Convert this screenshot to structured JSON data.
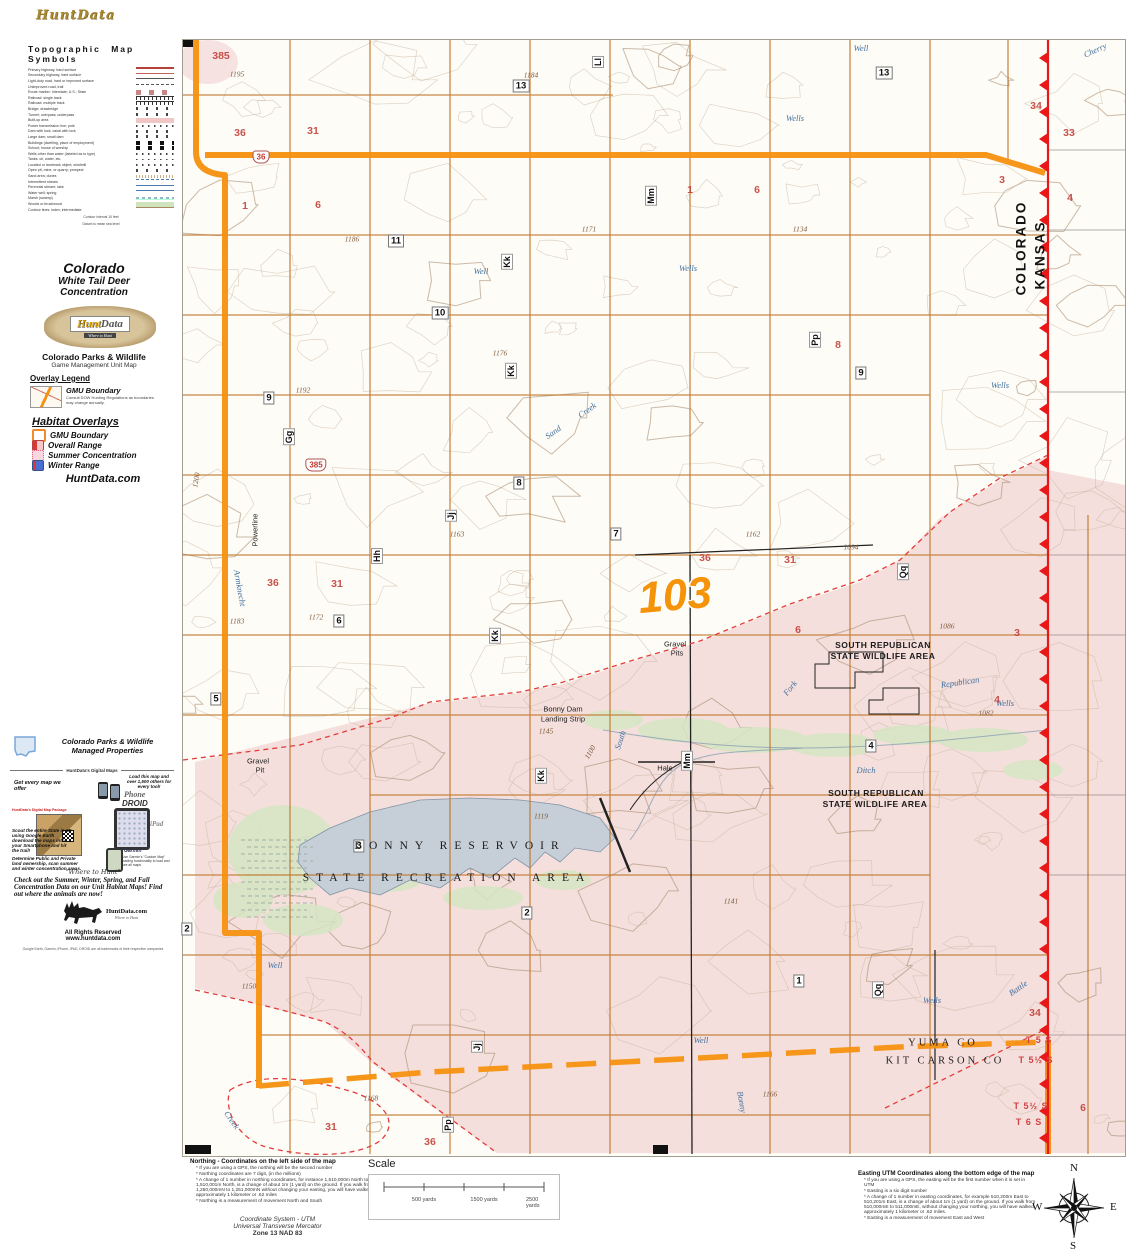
{
  "brand": {
    "script_logo": "HuntData",
    "name_hunt": "Hunt",
    "name_data": "Data",
    "tagline": "Where to Hunt",
    "site": "HuntData.com"
  },
  "sidebar": {
    "topo_legend": {
      "title": "Topographic  Map  Symbols",
      "items": [
        {
          "label": "Primary highway, hard surface",
          "sym": "red"
        },
        {
          "label": "Secondary highway, hard surface",
          "sym": "red2"
        },
        {
          "label": "Light-duty road, hard or improved surface",
          "sym": "thin"
        },
        {
          "label": "Unimproved road, trail",
          "sym": "dash"
        },
        {
          "label": "Route marker: Interstate; U.S.; State",
          "sym": "shield"
        },
        {
          "label": "Railroad: single track",
          "sym": "rr"
        },
        {
          "label": "Railroad: multiple track",
          "sym": "rr"
        },
        {
          "label": "Bridge; drawbridge",
          "sym": "tick"
        },
        {
          "label": "Tunnel; overpass; underpass",
          "sym": "tick"
        },
        {
          "label": "Built-up area",
          "sym": "pink"
        },
        {
          "label": "Power transmission line; pole",
          "sym": "dots"
        },
        {
          "label": "Dam with lock; canal with lock",
          "sym": "tick"
        },
        {
          "label": "Large dam; small dam",
          "sym": "tick"
        },
        {
          "label": "Buildings (dwelling, place of employment)",
          "sym": "blk"
        },
        {
          "label": "School; house of worship",
          "sym": "blk"
        },
        {
          "label": "Wells other than water (labeled as to type)",
          "sym": "dots"
        },
        {
          "label": "Tanks: oil, water, etc.",
          "sym": "dots"
        },
        {
          "label": "Located or landmark object; windmill",
          "sym": "dots"
        },
        {
          "label": "Open pit, mine, or quarry; prospect",
          "sym": "tick"
        },
        {
          "label": "Sand area; dunes",
          "sym": "stip"
        },
        {
          "label": "Intermittent stream",
          "sym": "bdash"
        },
        {
          "label": "Perennial stream; lake",
          "sym": "blue"
        },
        {
          "label": "Water well; spring",
          "sym": "blue"
        },
        {
          "label": "Marsh (swamp)",
          "sym": "marsh"
        },
        {
          "label": "Woods or brushwood",
          "sym": "green"
        },
        {
          "label": "Contour lines: index; intermediate",
          "sym": "cont"
        }
      ],
      "footnote1": "Contour interval 10 feet",
      "footnote2": "Datum is mean sea level"
    },
    "title_block": {
      "line1": "Colorado",
      "line2": "White Tail Deer",
      "line3": "Concentration"
    },
    "agency": {
      "line1": "Colorado Parks & Wildlife",
      "line2": "Game Management Unit Map"
    },
    "overlay_legend": {
      "title": "Overlay Legend",
      "item": "GMU Boundary",
      "note1": "Consult DOW Hunting Regulations as",
      "note2": "boundaries may change annually."
    },
    "habitat": {
      "title": "Habitat Overlays",
      "items": [
        {
          "label": "GMU Boundary",
          "style": "gmu",
          "color": "#f28c28"
        },
        {
          "label": "Overall Range",
          "style": "overall",
          "color": "#d43a3a"
        },
        {
          "label": "Summer Concentration",
          "style": "summer",
          "color": "#f2a0b4"
        },
        {
          "label": "Winter Range",
          "style": "winter",
          "color": "#4a6fd0"
        }
      ],
      "footer": "HuntData.com"
    },
    "managed": {
      "line1": "Colorado Parks & Wildlife",
      "line2": "Managed Properties"
    },
    "digital": {
      "header": "HuntData's Digital Maps",
      "left_pitch": "Get every map we offer",
      "right_pitch": "Load this map and over 1,500 others for every tool!",
      "phone": "Phone",
      "droid": "DROID",
      "ipad": "iPad",
      "garmin": "Garmin",
      "package": "HuntData's Digital Map Package",
      "scout": "Scout the entire State in 3D using Google Earth download the maps into your Smartphone and hit the trail!",
      "garmin_note": "Use Garmin's \"Custom Map\" loading functionality to load and see all maps",
      "determine": "Determine Public and Private land ownership, scan summer and winter concentration areas."
    },
    "where_script": "\"Where to Hunt\"",
    "promo": "Check out the Summer, Winter, Spring, and Fall Concentration Data on our Unit Habitat Maps!  Find out where the animals are now!",
    "rights": {
      "line1": "All Rights Reserved",
      "line2": "www.huntdata.com",
      "trademark": "Google Earth, Garmin, iPhone, iPAD, DROID are all trademarks of their respective companies"
    }
  },
  "map": {
    "unit": "103",
    "colors": {
      "gmu_boundary": "#f5930a",
      "state_line": "#e81818",
      "overall_range_fill": "#f3d7d6",
      "lake": "#c6cfd8",
      "section_number": "#c23b35"
    },
    "labels": [
      {
        "c": "mm",
        "t": "13",
        "x": 338,
        "y": 46
      },
      {
        "c": "mm",
        "t": "13",
        "x": 701,
        "y": 33
      },
      {
        "c": "mm",
        "t": "11",
        "x": 213,
        "y": 201
      },
      {
        "c": "mm",
        "t": "10",
        "x": 257,
        "y": 273
      },
      {
        "c": "mm",
        "t": "9",
        "x": 86,
        "y": 358
      },
      {
        "c": "mm",
        "t": "9",
        "x": 678,
        "y": 333
      },
      {
        "c": "mm",
        "t": "8",
        "x": 336,
        "y": 443
      },
      {
        "c": "mm",
        "t": "7",
        "x": 433,
        "y": 494
      },
      {
        "c": "mm",
        "t": "6",
        "x": 156,
        "y": 581
      },
      {
        "c": "mm",
        "t": "5",
        "x": 33,
        "y": 659
      },
      {
        "c": "mm",
        "t": "4",
        "x": 688,
        "y": 706
      },
      {
        "c": "mm",
        "t": "3",
        "x": 176,
        "y": 806
      },
      {
        "c": "mm",
        "t": "2",
        "x": 344,
        "y": 873
      },
      {
        "c": "mm",
        "t": "2",
        "x": 4,
        "y": 889
      },
      {
        "c": "mm",
        "t": "1",
        "x": 616,
        "y": 941
      },
      {
        "c": "sec",
        "t": "385",
        "x": 38,
        "y": 16
      },
      {
        "c": "sec",
        "t": "36",
        "x": 57,
        "y": 93
      },
      {
        "c": "sec",
        "t": "31",
        "x": 130,
        "y": 91
      },
      {
        "c": "sec",
        "t": "1",
        "x": 62,
        "y": 166
      },
      {
        "c": "sec",
        "t": "6",
        "x": 135,
        "y": 165
      },
      {
        "c": "sec",
        "t": "1",
        "x": 507,
        "y": 150
      },
      {
        "c": "sec",
        "t": "6",
        "x": 574,
        "y": 150
      },
      {
        "c": "sec",
        "t": "34",
        "x": 853,
        "y": 66
      },
      {
        "c": "sec",
        "t": "33",
        "x": 886,
        "y": 93
      },
      {
        "c": "sec",
        "t": "3",
        "x": 819,
        "y": 140
      },
      {
        "c": "sec",
        "t": "4",
        "x": 887,
        "y": 158
      },
      {
        "c": "sec",
        "t": "8",
        "x": 655,
        "y": 305
      },
      {
        "c": "sec",
        "t": "36",
        "x": 90,
        "y": 543
      },
      {
        "c": "sec",
        "t": "31",
        "x": 154,
        "y": 544
      },
      {
        "c": "sec",
        "t": "36",
        "x": 522,
        "y": 518
      },
      {
        "c": "sec",
        "t": "31",
        "x": 607,
        "y": 520
      },
      {
        "c": "sec",
        "t": "6",
        "x": 615,
        "y": 590
      },
      {
        "c": "sec",
        "t": "3",
        "x": 834,
        "y": 593
      },
      {
        "c": "sec",
        "t": "4",
        "x": 814,
        "y": 660
      },
      {
        "c": "sec",
        "t": "34",
        "x": 852,
        "y": 973
      },
      {
        "c": "sec",
        "t": "6",
        "x": 900,
        "y": 1068
      },
      {
        "c": "sec",
        "t": "31",
        "x": 148,
        "y": 1087
      },
      {
        "c": "sec",
        "t": "36",
        "x": 247,
        "y": 1102
      },
      {
        "c": "sh",
        "t": "36",
        "x": 78,
        "y": 117
      },
      {
        "c": "sh",
        "t": "385",
        "x": 133,
        "y": 425
      },
      {
        "c": "rd",
        "t": "Ll",
        "x": 415,
        "y": 22,
        "r": -90
      },
      {
        "c": "rd",
        "t": "Mm",
        "x": 468,
        "y": 156,
        "r": -90
      },
      {
        "c": "rd",
        "t": "Kk",
        "x": 324,
        "y": 222,
        "r": -90
      },
      {
        "c": "rd",
        "t": "Kk",
        "x": 328,
        "y": 331,
        "r": -90
      },
      {
        "c": "rd",
        "t": "Gg",
        "x": 106,
        "y": 397,
        "r": -90
      },
      {
        "c": "rd",
        "t": "Hh",
        "x": 194,
        "y": 516,
        "r": -90
      },
      {
        "c": "rd",
        "t": "Jj",
        "x": 268,
        "y": 476,
        "r": -90
      },
      {
        "c": "rd",
        "t": "Kk",
        "x": 312,
        "y": 596,
        "r": -90
      },
      {
        "c": "rd",
        "t": "Kk",
        "x": 358,
        "y": 736,
        "r": -90
      },
      {
        "c": "rd",
        "t": "Mm",
        "x": 504,
        "y": 721,
        "r": -90
      },
      {
        "c": "rd",
        "t": "Pp",
        "x": 632,
        "y": 300,
        "r": -90
      },
      {
        "c": "rd",
        "t": "Qq",
        "x": 720,
        "y": 532,
        "r": -90
      },
      {
        "c": "rd",
        "t": "Jj",
        "x": 294,
        "y": 1007,
        "r": -90
      },
      {
        "c": "rd",
        "t": "Pp",
        "x": 265,
        "y": 1085,
        "r": -90
      },
      {
        "c": "rd",
        "t": "Qq",
        "x": 695,
        "y": 950,
        "r": -90
      },
      {
        "c": "el",
        "t": "1195",
        "x": 54,
        "y": 34
      },
      {
        "c": "el",
        "t": "1184",
        "x": 348,
        "y": 35
      },
      {
        "c": "el",
        "t": "1186",
        "x": 169,
        "y": 199
      },
      {
        "c": "el",
        "t": "1171",
        "x": 406,
        "y": 189
      },
      {
        "c": "el",
        "t": "1134",
        "x": 617,
        "y": 189
      },
      {
        "c": "el",
        "t": "1176",
        "x": 317,
        "y": 313
      },
      {
        "c": "el",
        "t": "1192",
        "x": 120,
        "y": 350
      },
      {
        "c": "el",
        "t": "1163",
        "x": 274,
        "y": 494
      },
      {
        "c": "el",
        "t": "1162",
        "x": 570,
        "y": 494
      },
      {
        "c": "el",
        "t": "1094",
        "x": 668,
        "y": 507
      },
      {
        "c": "el",
        "t": "1172",
        "x": 133,
        "y": 577
      },
      {
        "c": "el",
        "t": "1183",
        "x": 54,
        "y": 581
      },
      {
        "c": "el",
        "t": "1086",
        "x": 764,
        "y": 586
      },
      {
        "c": "el",
        "t": "1082",
        "x": 803,
        "y": 673
      },
      {
        "c": "el",
        "t": "1145",
        "x": 363,
        "y": 691
      },
      {
        "c": "el",
        "t": "1100",
        "x": 407,
        "y": 712,
        "r": -60
      },
      {
        "c": "el",
        "t": "1119",
        "x": 358,
        "y": 776
      },
      {
        "c": "el",
        "t": "1141",
        "x": 548,
        "y": 861
      },
      {
        "c": "el",
        "t": "1150",
        "x": 66,
        "y": 946
      },
      {
        "c": "el",
        "t": "1168",
        "x": 188,
        "y": 1058
      },
      {
        "c": "el",
        "t": "1166",
        "x": 587,
        "y": 1054
      },
      {
        "c": "el",
        "t": "1200",
        "x": 13,
        "y": 440,
        "r": -80
      },
      {
        "c": "wa",
        "t": "Well",
        "x": 298,
        "y": 231
      },
      {
        "c": "wa",
        "t": "Wells",
        "x": 505,
        "y": 228
      },
      {
        "c": "wa",
        "t": "Wells",
        "x": 612,
        "y": 78
      },
      {
        "c": "wa",
        "t": "Well",
        "x": 678,
        "y": 8
      },
      {
        "c": "wa",
        "t": "Wells",
        "x": 817,
        "y": 345
      },
      {
        "c": "wa",
        "t": "Wells",
        "x": 822,
        "y": 663
      },
      {
        "c": "wa",
        "t": "Wells",
        "x": 749,
        "y": 960
      },
      {
        "c": "wa",
        "t": "Well",
        "x": 92,
        "y": 925
      },
      {
        "c": "wa",
        "t": "Well",
        "x": 518,
        "y": 1000
      },
      {
        "c": "wa",
        "t": "Sand",
        "x": 370,
        "y": 392,
        "r": -35
      },
      {
        "c": "wa",
        "t": "Creek",
        "x": 404,
        "y": 370,
        "r": -35
      },
      {
        "c": "wa",
        "t": "Republican",
        "x": 777,
        "y": 642,
        "r": -8
      },
      {
        "c": "wa",
        "t": "Fork",
        "x": 607,
        "y": 648,
        "r": -50
      },
      {
        "c": "wa",
        "t": "South",
        "x": 437,
        "y": 700,
        "r": -72
      },
      {
        "c": "wa",
        "t": "Bonny",
        "x": 559,
        "y": 1062,
        "r": 80
      },
      {
        "c": "wa",
        "t": "Creek",
        "x": 49,
        "y": 1080,
        "r": 55
      },
      {
        "c": "wa",
        "t": "Battle",
        "x": 835,
        "y": 948,
        "r": -35
      },
      {
        "c": "wa",
        "t": "Ditch",
        "x": 683,
        "y": 730
      },
      {
        "c": "wa",
        "t": "Cherry",
        "x": 912,
        "y": 10,
        "r": -25
      },
      {
        "c": "wa",
        "t": "Armknecht",
        "x": 57,
        "y": 548,
        "r": 80
      },
      {
        "c": "pl",
        "t": "Gravel",
        "x": 492,
        "y": 604
      },
      {
        "c": "pl",
        "t": "Pits",
        "x": 494,
        "y": 613
      },
      {
        "c": "pl",
        "t": "Gravel",
        "x": 75,
        "y": 721
      },
      {
        "c": "pl",
        "t": "Pit",
        "x": 77,
        "y": 730
      },
      {
        "c": "pl",
        "t": "Bonny Dam",
        "x": 380,
        "y": 669
      },
      {
        "c": "pl",
        "t": "Landing Strip",
        "x": 380,
        "y": 679
      },
      {
        "c": "pl",
        "t": "Hale",
        "x": 482,
        "y": 728
      },
      {
        "c": "pl",
        "t": "Powerline",
        "x": 72,
        "y": 490,
        "r": -90
      },
      {
        "c": "pls",
        "t": "BONNY RESERVOIR",
        "x": 277,
        "y": 806
      },
      {
        "c": "pls",
        "t": "STATE RECREATION AREA",
        "x": 264,
        "y": 838
      },
      {
        "c": "pla",
        "t": "SOUTH REPUBLICAN",
        "x": 700,
        "y": 605
      },
      {
        "c": "pla",
        "t": "STATE WILDLIFE AREA",
        "x": 700,
        "y": 616
      },
      {
        "c": "pla",
        "t": "SOUTH REPUBLICAN",
        "x": 693,
        "y": 753
      },
      {
        "c": "pla",
        "t": "STATE WILDLIFE AREA",
        "x": 692,
        "y": 764
      },
      {
        "c": "co",
        "t": "YUMA CO",
        "x": 760,
        "y": 1003
      },
      {
        "c": "co",
        "t": "KIT CARSON CO",
        "x": 762,
        "y": 1021
      },
      {
        "c": "tw",
        "t": "T 5 S",
        "x": 856,
        "y": 1000
      },
      {
        "c": "tw",
        "t": "T 5½ S",
        "x": 853,
        "y": 1020
      },
      {
        "c": "tw",
        "t": "T 5½ S",
        "x": 848,
        "y": 1066
      },
      {
        "c": "tw",
        "t": "T 6 S",
        "x": 846,
        "y": 1082
      },
      {
        "c": "st",
        "t": "COLORADO",
        "x": 838,
        "y": 208,
        "r": -90
      },
      {
        "c": "st",
        "t": "KANSAS",
        "x": 857,
        "y": 215,
        "r": -90
      },
      {
        "c": "big",
        "t": "103",
        "x": 492,
        "y": 556,
        "r": -5
      }
    ]
  },
  "footer": {
    "northing": {
      "title": "Northing - Coordinates on the left side of the map",
      "bullets": [
        "* If you are using a GPS, the northing will be the second number",
        "* Northing coordinates are 7 digit, (in the millions)",
        "* A change of 1 number in northing coordinates, for instance 1,510,000m North to 1,510,001m North, is a change of about 1m (1 yard) on the ground.  If you walk from 1,250,000mN to 1,251,000mN without changing your easting, you will have walked approximately 1 kilometer or .62 miles",
        "* Northing is a measurement of movement North and South"
      ]
    },
    "scale": {
      "title": "Scale",
      "ticks": [
        "500 yards",
        "1500 yards",
        "2500 yards"
      ]
    },
    "coordsys": {
      "line1": "Coordinate System - UTM",
      "line2": "Universal Transverse Mercator",
      "line3": "Zone 13  NAD 83"
    },
    "easting": {
      "title": "Easting UTM Coordinates along the bottom edge of the map",
      "bullets": [
        "* If you are using a GPS, the easting will be the first number when it is set in UTM",
        "* Easting is a six digit number",
        "* A change of 1 number in easting coordinates, for example 510,200m East to 510,201m East, is a change of about 1m (1 yard) on the ground.  If you walk from 510,000mE to 511,000mE, without changing your northing, you will have walked approximately 1 kilometer or .62 miles.",
        "* Easting is a measurement of movement East and West"
      ]
    },
    "compass": {
      "n": "N",
      "e": "E",
      "s": "S",
      "w": "W"
    }
  }
}
